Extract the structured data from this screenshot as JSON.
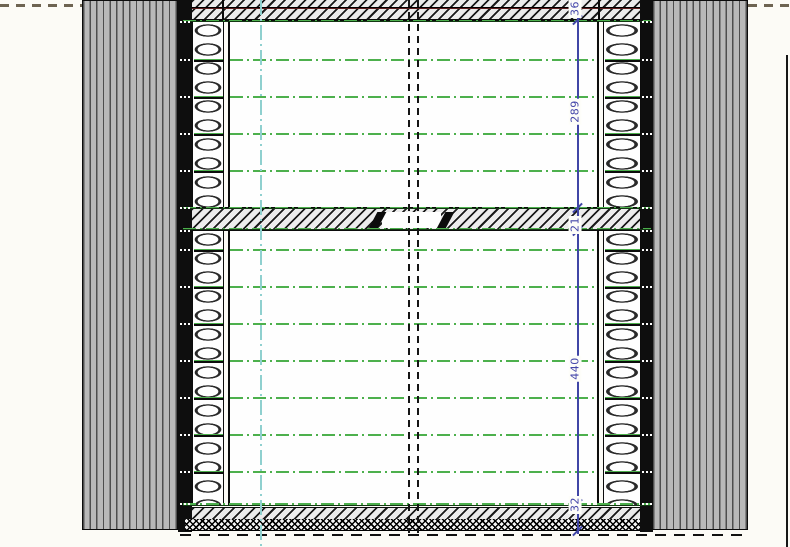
{
  "drawing": {
    "type": "architectural-section",
    "description": "horizontal cross-section of timber-frame wall assembly between two clad walls",
    "colors": {
      "grid_green": "#4db04d",
      "centerline_cyan": "#8fd0cf",
      "dimension_blue": "#4046a6",
      "membrane_maroon": "#5d1d1d",
      "cladding_gray": "#b9b9b9",
      "line_black": "#0c0c0c"
    },
    "green_line_ys": [
      60,
      97,
      134,
      171,
      250,
      287,
      324,
      361,
      398,
      435,
      472
    ],
    "band_edge_green_ys": [
      19.5,
      206.5,
      227.7,
      503.2
    ],
    "stud_dot_ys": [
      22,
      60,
      97,
      134,
      171,
      208,
      231,
      250,
      287,
      324,
      361,
      398,
      435,
      472,
      504
    ],
    "insulation_divider_ys": [
      60,
      97,
      134,
      171,
      250,
      287,
      324,
      361,
      398,
      435,
      472
    ]
  },
  "dimension": {
    "line_x": 578,
    "tick_ys": [
      20,
      208,
      231,
      504,
      531
    ],
    "segments": [
      {
        "label": "36",
        "label_y": 9
      },
      {
        "label": "289",
        "label_y": 112
      },
      {
        "label": "21",
        "label_y": 225
      },
      {
        "label": "440",
        "label_y": 369
      },
      {
        "label": "32",
        "label_y": 505
      }
    ]
  }
}
